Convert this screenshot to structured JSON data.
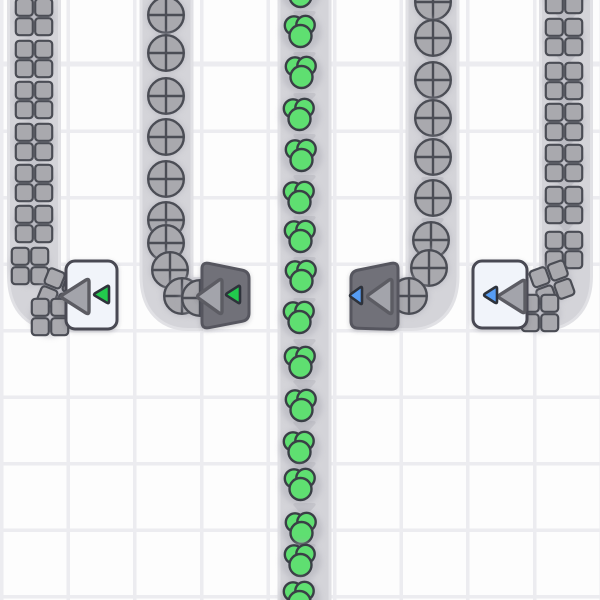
{
  "scene": {
    "width": 600,
    "height": 600,
    "kind": "factory-game-conveyor-view"
  },
  "grid": {
    "cell_w": 66.6,
    "cell_h": 66.5,
    "line_width": 3.5,
    "line_color": "#ececf0",
    "cell_color": "#fdfdfd",
    "phase_y": 63
  },
  "palette": {
    "belt_fill": "#d4d4d9",
    "belt_edge": "#e1e1e5",
    "chevron": "#c5c5cb",
    "shape_gray": "#a9a9ae",
    "shape_outline": "#4b4d55",
    "color_green": "#5fdf71",
    "color_green_outline": "#3a3f46",
    "white_building_fill": "#f1f4fa",
    "white_building_border": "#484a52",
    "dark_building_fill": "#717179",
    "dark_building_border": "#56575f",
    "arrow_gray_fill": "#a3a4ab",
    "arrow_gray_outline": "#5b5c64",
    "arrow_green": "#22c94d",
    "arrow_blue": "#569df5",
    "arrow_outline": "#2e333a",
    "item_shadow": "#aaaab4"
  },
  "belts": [
    {
      "id": "belt-squares-left",
      "item": "square",
      "direction": "down-then-right",
      "path": "M 34 -8 L 34 276 Q 34 304 56 304 L 68 304",
      "chevron_x": 34,
      "chevron_ys": [
        12,
        53,
        95,
        136,
        178,
        219
      ]
    },
    {
      "id": "belt-circles-left",
      "item": "circle",
      "direction": "down-then-right",
      "path": "M 166.5 -8 L 166.5 276 Q 166.5 304 188 304 L 203 304",
      "chevron_x": 166.5,
      "chevron_ys": [
        12,
        53,
        95,
        136,
        178,
        219
      ]
    },
    {
      "id": "belt-green-center",
      "item": "green-cluster",
      "direction": "down",
      "path": "M 304.5 -8 L 304.5 608",
      "chevron_x": 304.5,
      "chevron_ys": [
        12,
        53,
        94,
        135,
        176,
        217,
        258,
        299,
        340,
        381,
        422,
        463,
        504,
        545,
        586
      ]
    },
    {
      "id": "belt-circles-right",
      "item": "circle",
      "direction": "down-then-left",
      "path": "M 432.5 -8 L 432.5 276 Q 432.5 304 411 304 L 396 304",
      "chevron_x": 432.5,
      "chevron_ys": [
        12,
        53,
        95,
        136,
        178,
        219
      ]
    },
    {
      "id": "belt-squares-right",
      "item": "square",
      "direction": "down-then-left",
      "path": "M 566 -8 L 566 276 Q 566 304 544 304 L 526 304",
      "chevron_x": 566,
      "chevron_ys": [
        12,
        53,
        95,
        136,
        178,
        219
      ]
    }
  ],
  "items": {
    "belt-squares-left": [
      {
        "x": 34,
        "y": 17
      },
      {
        "x": 34,
        "y": 59
      },
      {
        "x": 34,
        "y": 100
      },
      {
        "x": 34,
        "y": 142
      },
      {
        "x": 34,
        "y": 183
      },
      {
        "x": 34,
        "y": 224
      },
      {
        "x": 30,
        "y": 266
      },
      {
        "x": 60,
        "y": 291,
        "r": 22
      },
      {
        "x": 50,
        "y": 317
      }
    ],
    "belt-circles-left": [
      {
        "x": 166,
        "y": 15
      },
      {
        "x": 166,
        "y": 53
      },
      {
        "x": 166,
        "y": 96
      },
      {
        "x": 166,
        "y": 137
      },
      {
        "x": 166,
        "y": 179
      },
      {
        "x": 166,
        "y": 220
      },
      {
        "x": 166,
        "y": 243
      },
      {
        "x": 170,
        "y": 270
      },
      {
        "x": 182,
        "y": 296
      },
      {
        "x": 200,
        "y": 298
      }
    ],
    "belt-green-center": [
      {
        "x": 301,
        "y": -8
      },
      {
        "x": 301,
        "y": 32
      },
      {
        "x": 302,
        "y": 73
      },
      {
        "x": 300,
        "y": 115
      },
      {
        "x": 302,
        "y": 156
      },
      {
        "x": 300,
        "y": 198
      },
      {
        "x": 301,
        "y": 237
      },
      {
        "x": 302,
        "y": 277
      },
      {
        "x": 300,
        "y": 318
      },
      {
        "x": 301,
        "y": 363
      },
      {
        "x": 302,
        "y": 406
      },
      {
        "x": 300,
        "y": 448
      },
      {
        "x": 301,
        "y": 485
      },
      {
        "x": 302,
        "y": 529
      },
      {
        "x": 301,
        "y": 561
      },
      {
        "x": 300,
        "y": 598
      }
    ],
    "belt-circles-right": [
      {
        "x": 433,
        "y": 2
      },
      {
        "x": 433,
        "y": 38
      },
      {
        "x": 433,
        "y": 80
      },
      {
        "x": 433,
        "y": 118
      },
      {
        "x": 433,
        "y": 157
      },
      {
        "x": 433,
        "y": 198
      },
      {
        "x": 431,
        "y": 240
      },
      {
        "x": 429,
        "y": 268
      },
      {
        "x": 409,
        "y": 296
      }
    ],
    "belt-squares-right": [
      {
        "x": 564,
        "y": -5
      },
      {
        "x": 564,
        "y": 37
      },
      {
        "x": 564,
        "y": 81
      },
      {
        "x": 564,
        "y": 122
      },
      {
        "x": 564,
        "y": 163
      },
      {
        "x": 564,
        "y": 205
      },
      {
        "x": 564,
        "y": 250
      },
      {
        "x": 552,
        "y": 283,
        "r": -20
      },
      {
        "x": 540,
        "y": 313
      }
    ]
  },
  "buildings": [
    {
      "id": "receiver-green",
      "type": "white-box",
      "x": 66,
      "y": 261,
      "w": 51,
      "h": 68,
      "arrows": [
        {
          "kind": "gray",
          "points": [
            [
              89,
              278
            ],
            [
              89,
              315
            ],
            [
              60,
              296.5
            ]
          ]
        },
        {
          "kind": "green",
          "points": [
            [
              109,
              285
            ],
            [
              109,
              304
            ],
            [
              93,
              294.5
            ]
          ]
        }
      ]
    },
    {
      "id": "launcher-green",
      "type": "dark-trapezoid",
      "points": [
        [
          202,
          262
        ],
        [
          249,
          271.5
        ],
        [
          249,
          320
        ],
        [
          202,
          329
        ]
      ],
      "arrows": [
        {
          "kind": "gray",
          "points": [
            [
              222,
              278
            ],
            [
              222,
              315
            ],
            [
              196,
              296.5
            ]
          ]
        },
        {
          "kind": "green",
          "points": [
            [
              240,
              285
            ],
            [
              240,
              304
            ],
            [
              225,
              294.5
            ]
          ]
        }
      ]
    },
    {
      "id": "launcher-blue",
      "type": "dark-trapezoid",
      "points": [
        [
          351,
          271.5
        ],
        [
          398,
          262
        ],
        [
          398,
          329.5
        ],
        [
          351,
          328
        ]
      ],
      "arrows": [
        {
          "kind": "gray",
          "points": [
            [
              392,
              278
            ],
            [
              392,
              315
            ],
            [
              366,
              296.5
            ]
          ]
        },
        {
          "kind": "blue",
          "points": [
            [
              362,
              286
            ],
            [
              362,
              305
            ],
            [
              349,
              295.5
            ]
          ]
        }
      ]
    },
    {
      "id": "receiver-blue",
      "type": "white-box",
      "x": 473,
      "y": 261,
      "w": 54,
      "h": 67,
      "arrows": [
        {
          "kind": "gray",
          "points": [
            [
              525,
              279
            ],
            [
              525,
              314
            ],
            [
              497,
              296.5
            ]
          ]
        },
        {
          "kind": "blue",
          "points": [
            [
              497,
              286
            ],
            [
              497,
              304
            ],
            [
              483,
              295
            ]
          ]
        }
      ]
    }
  ]
}
